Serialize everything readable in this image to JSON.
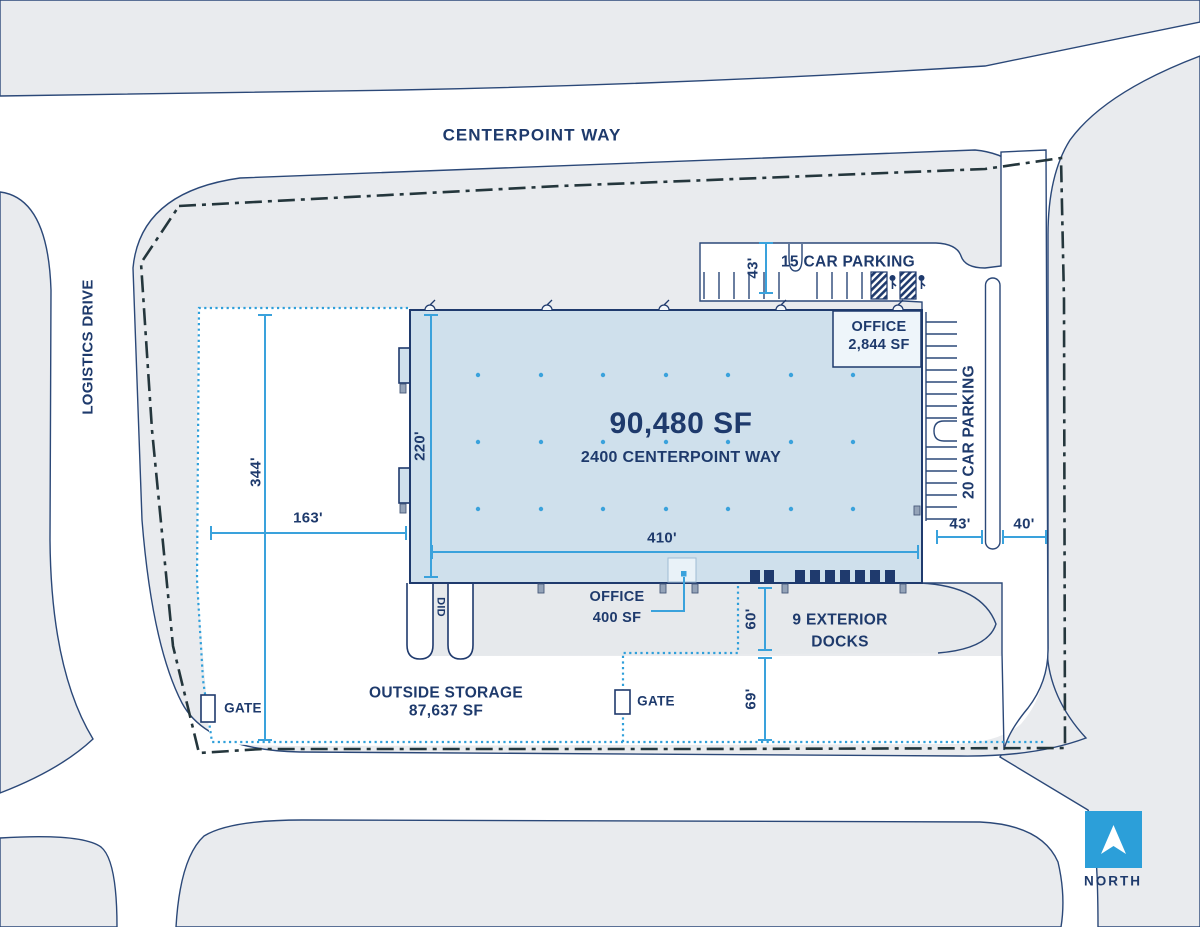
{
  "streets": {
    "top": "CENTERPOINT WAY",
    "left": "LOGISTICS DRIVE"
  },
  "building": {
    "area": "90,480 SF",
    "address": "2400 CENTERPOINT WAY",
    "office_upper": {
      "line1": "OFFICE",
      "line2": "2,844 SF"
    },
    "office_lower": {
      "line1": "OFFICE",
      "line2": "400 SF"
    },
    "docks": {
      "line1": "9 EXTERIOR",
      "line2": "DOCKS"
    },
    "drive_in_door": "DID"
  },
  "parking": {
    "top": "15 CAR PARKING",
    "right": "20 CAR PARKING"
  },
  "storage": {
    "line1": "OUTSIDE STORAGE",
    "line2": "87,637 SF"
  },
  "gates": {
    "gate1": "GATE",
    "gate2": "GATE"
  },
  "dimensions": {
    "building_width": "410'",
    "building_depth": "220'",
    "yard_depth": "344'",
    "yard_width": "163'",
    "parking_top_depth": "43'",
    "truck_court_depth": "60'",
    "south_yard_depth": "69'",
    "parking_right_width": "43'",
    "drive_right_width": "40'"
  },
  "compass": {
    "label": "NORTH"
  },
  "colors": {
    "text_navy": "#1e3a6c",
    "line_navy": "#2b4878",
    "dimension_blue": "#3aa2dc",
    "dotted_storage_blue": "#2f9fda",
    "property_line_dark": "#24363c",
    "building_fill": "#cfe0ec",
    "parcel_gray": "#e9ebee",
    "north_arrow_blue": "#2c9fd9"
  }
}
